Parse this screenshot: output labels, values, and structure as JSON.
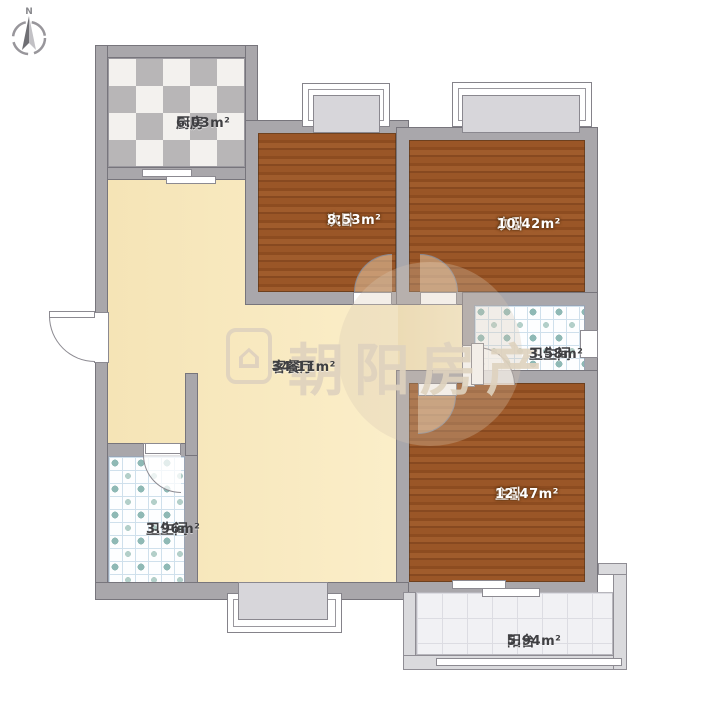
{
  "compass": {
    "label": "N"
  },
  "watermark": {
    "logo_icon": "house-icon",
    "text": "朝阳房产"
  },
  "rooms": {
    "kitchen": {
      "name": "厨房",
      "area": "6.03m²"
    },
    "bedroom_a": {
      "name": "次卧",
      "area": "8.53m²"
    },
    "bedroom_b": {
      "name": "次卧",
      "area": "10.42m²"
    },
    "living": {
      "name": "客餐厅",
      "area": "34.11m²"
    },
    "bath_right": {
      "name": "卫生间",
      "area": "3.58m²"
    },
    "master": {
      "name": "主卧",
      "area": "12.47m²"
    },
    "bath_left": {
      "name": "卫生间",
      "area": "3.96m²"
    },
    "balcony": {
      "name": "阳台",
      "area": "5.94m²"
    }
  },
  "colors": {
    "wall": "#a9a7ab",
    "wallEdge": "#77757c",
    "balWall": "#dadadd",
    "wood": "#94511f",
    "cream": "#f9e9c2",
    "checker": "#b8b6b7",
    "dot": "#8fb9b5",
    "tileline": "#cfe0ec"
  }
}
